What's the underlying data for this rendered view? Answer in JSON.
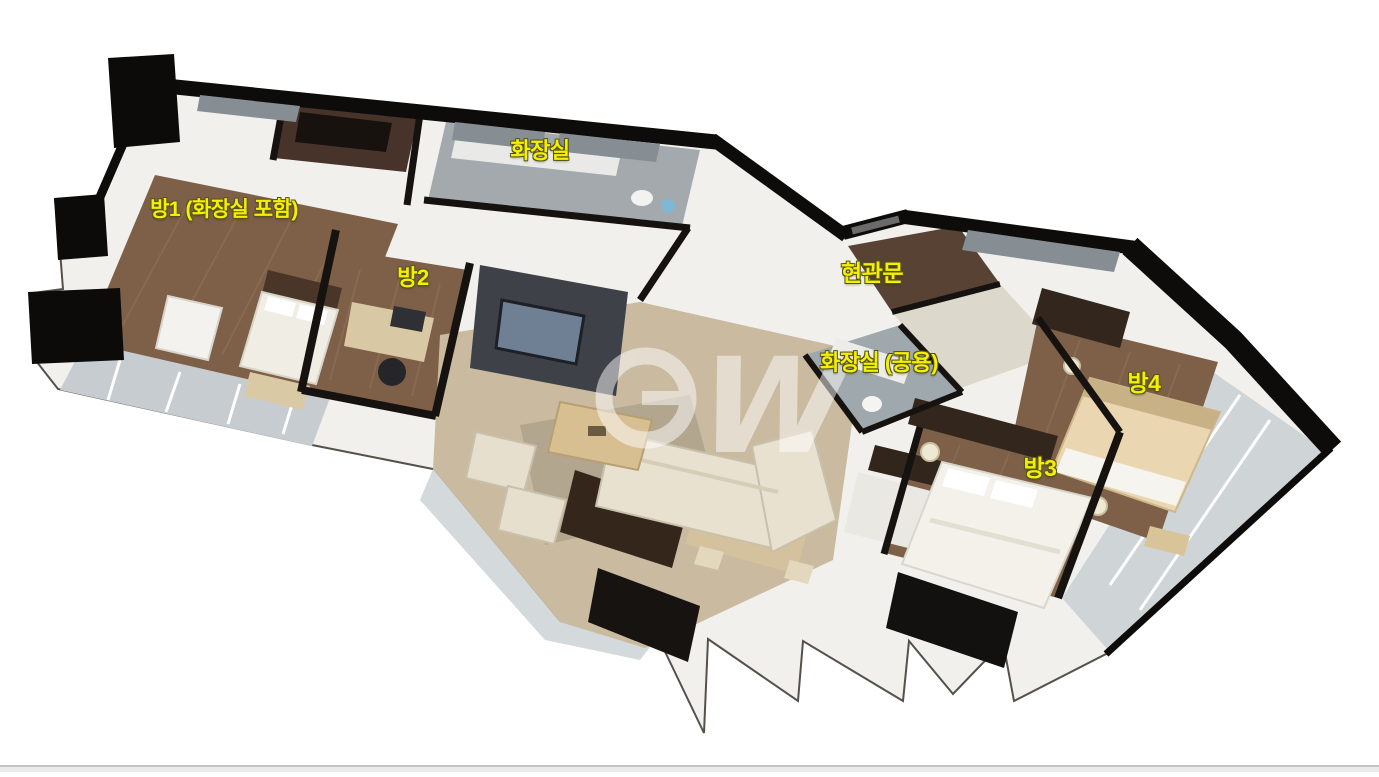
{
  "image": {
    "type": "3d-isometric-floor-plan",
    "background": "#ffffff"
  },
  "labels": {
    "room1": {
      "text": "방1 (화장실 포함)",
      "x": 224,
      "y": 208
    },
    "bath1": {
      "text": "화장실",
      "x": 540,
      "y": 149
    },
    "room2": {
      "text": "방2",
      "x": 413,
      "y": 276
    },
    "entrance": {
      "text": "현관문",
      "x": 872,
      "y": 271
    },
    "bath_shared": {
      "text": "화장실 (공용)",
      "x": 879,
      "y": 361
    },
    "room3": {
      "text": "방3",
      "x": 1040,
      "y": 466
    },
    "room4": {
      "text": "방4",
      "x": 1144,
      "y": 381
    }
  },
  "watermark": {
    "letter_w": "W"
  },
  "colors": {
    "label_yellow": "#f6ef00",
    "label_outline": "#55551a",
    "wall_black": "#0e0c0a",
    "wall_light": "#f1f0ec",
    "wood_floor": "#7e5f47",
    "living_floor": "#c9baa0",
    "bath_tile": "#a3a9ac",
    "balcony_glass": "#c9ced2",
    "dark_wood": "#35261b"
  }
}
